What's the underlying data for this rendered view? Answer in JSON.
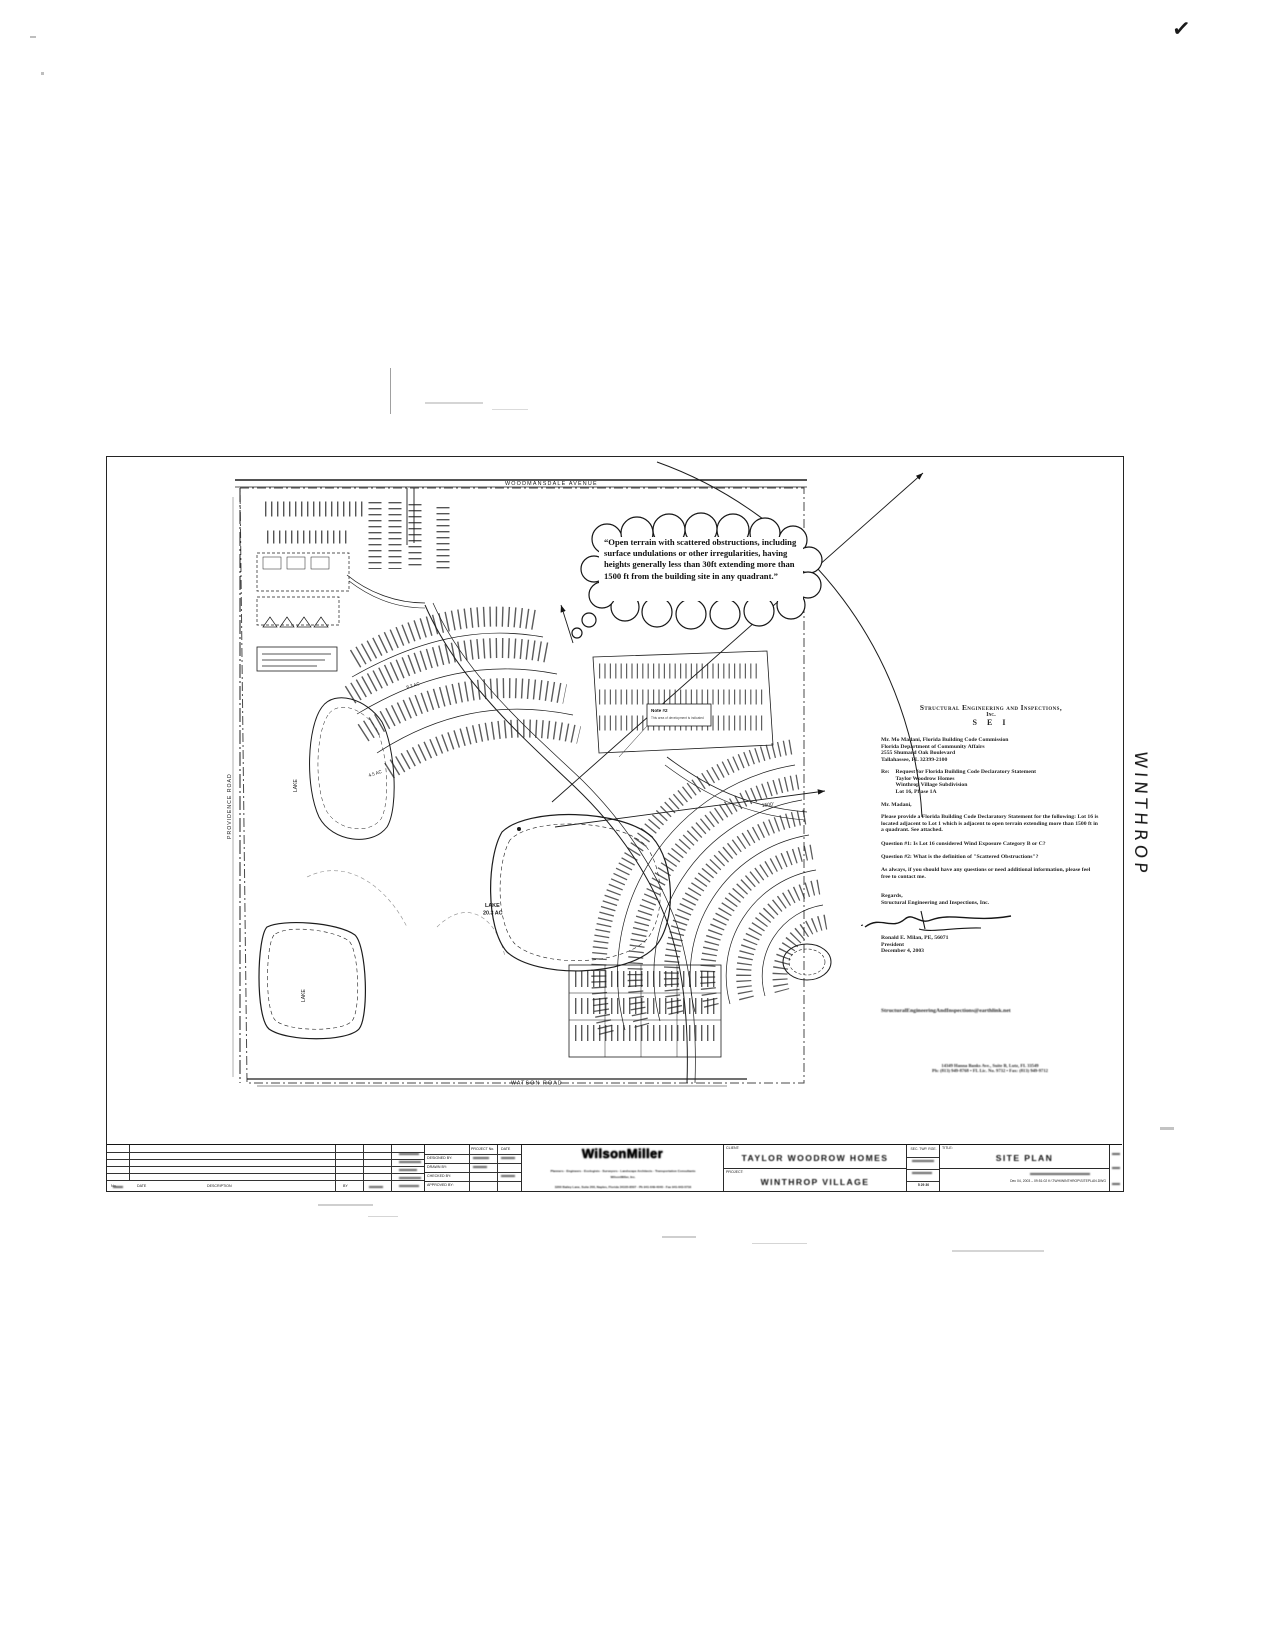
{
  "artifacts": {
    "checkmark": "✓",
    "handwritten": "WINTHROP"
  },
  "callout": {
    "text": "“Open terrain with scattered obstructions, including surface undulations or other irregularities, having heights generally less than 30ft extending more than 1500 ft from the building site in any quadrant.”"
  },
  "map": {
    "road_top": "WOODMANSDALE AVENUE",
    "road_left": "PROVIDENCE ROAD",
    "road_bottom": "WATSON ROAD",
    "lake_center_line1": "LAKE",
    "lake_center_line2": "20.3 AC",
    "lake_west": "LAKE",
    "lake_south": "LAKE",
    "area_label_1": "4.5 AC",
    "area_label_2": "8.2 AC",
    "radius_label": "1500'",
    "note_line1": "Note #2",
    "note_line2": "This area of development is indicated"
  },
  "letter": {
    "firm_line1": "Structural Engineering and Inspections,",
    "firm_line2": "Inc.",
    "firm_line3": "S E I",
    "recipient": [
      "Mr. Mo Madani, Florida Building Code Commission",
      "Florida Department of Community Affairs",
      "2555 Shumard Oak Boulevard",
      "Tallahassee, FL 32399-2100"
    ],
    "re_label": "Re:",
    "re_lines": [
      "Request for Florida Building Code Declaratory Statement",
      "Taylor Woodrow Homes",
      "Winthrop Village Subdivision",
      "Lot 16, Phase 1A"
    ],
    "salutation": "Mr. Madani,",
    "body": [
      "Please provide a Florida Building Code Declaratory Statement for the following: Lot 16 is located adjacent to Lot 1 which is adjacent to open terrain extending more than 1500 ft in a quadrant.  See attached.",
      "Question #1:  Is Lot 16 considered Wind Exposure Category B or C?",
      "Question #2:  What is the definition of \"Scattered Obstructions\"?",
      "As always, if you should have any questions or need additional information, please feel free to contact me."
    ],
    "closing": [
      "Regards,",
      "Structural Engineering and Inspections, Inc."
    ],
    "signer_name": "Ronald E. Milan, PE, 56071",
    "signer_title": "President",
    "signer_date": "December 4, 2003",
    "email_line": "StructuralEngineeringAndInspections@earthlink.net",
    "footer_line1": "14349 Hanna Banks Ave., Suite B, Lutz, FL 33549",
    "footer_line2": "Ph: (813) 949-8768   •   FL Lic. No. 9732   •   Fax: (813) 949-9712"
  },
  "title_block": {
    "rev_no_label": "No.",
    "rev_date_label": "DATE",
    "rev_desc_label": "DESCRIPTION",
    "rev_by_label": "BY",
    "credits_h1": "PROJECT No.",
    "credits_h2": "DATE",
    "credits_r1": "DESIGNED BY:",
    "credits_r2": "DRAWN BY:",
    "credits_r3": "CHECKED BY:",
    "credits_r4": "APPROVED BY:",
    "firm_logo": "WilsonMiller",
    "firm_tagline": "Planners · Engineers · Ecologists · Surveyors · Landscape Architects · Transportation Consultants",
    "firm_sub": "WilsonMiller, Inc.",
    "firm_address": "3200 Bailey Lane, Suite 200, Naples, Florida 34105-8507 · Ph 941-649-4040 · Fax 941-643-5716",
    "client_label": "CLIENT:",
    "client": "TAYLOR WOODROW HOMES",
    "project_label": "PROJECT:",
    "project": "WINTHROP VILLAGE",
    "sec_label": "SEC. TWP. RGE.",
    "sec_values": "5  29  30",
    "title_label": "TITLE:",
    "title": "SITE PLAN",
    "plot_stamp": "Dec 04, 2003 – 09:51:02   K:\\TWH\\WINTHROP\\SITEPLAN.DWG"
  }
}
